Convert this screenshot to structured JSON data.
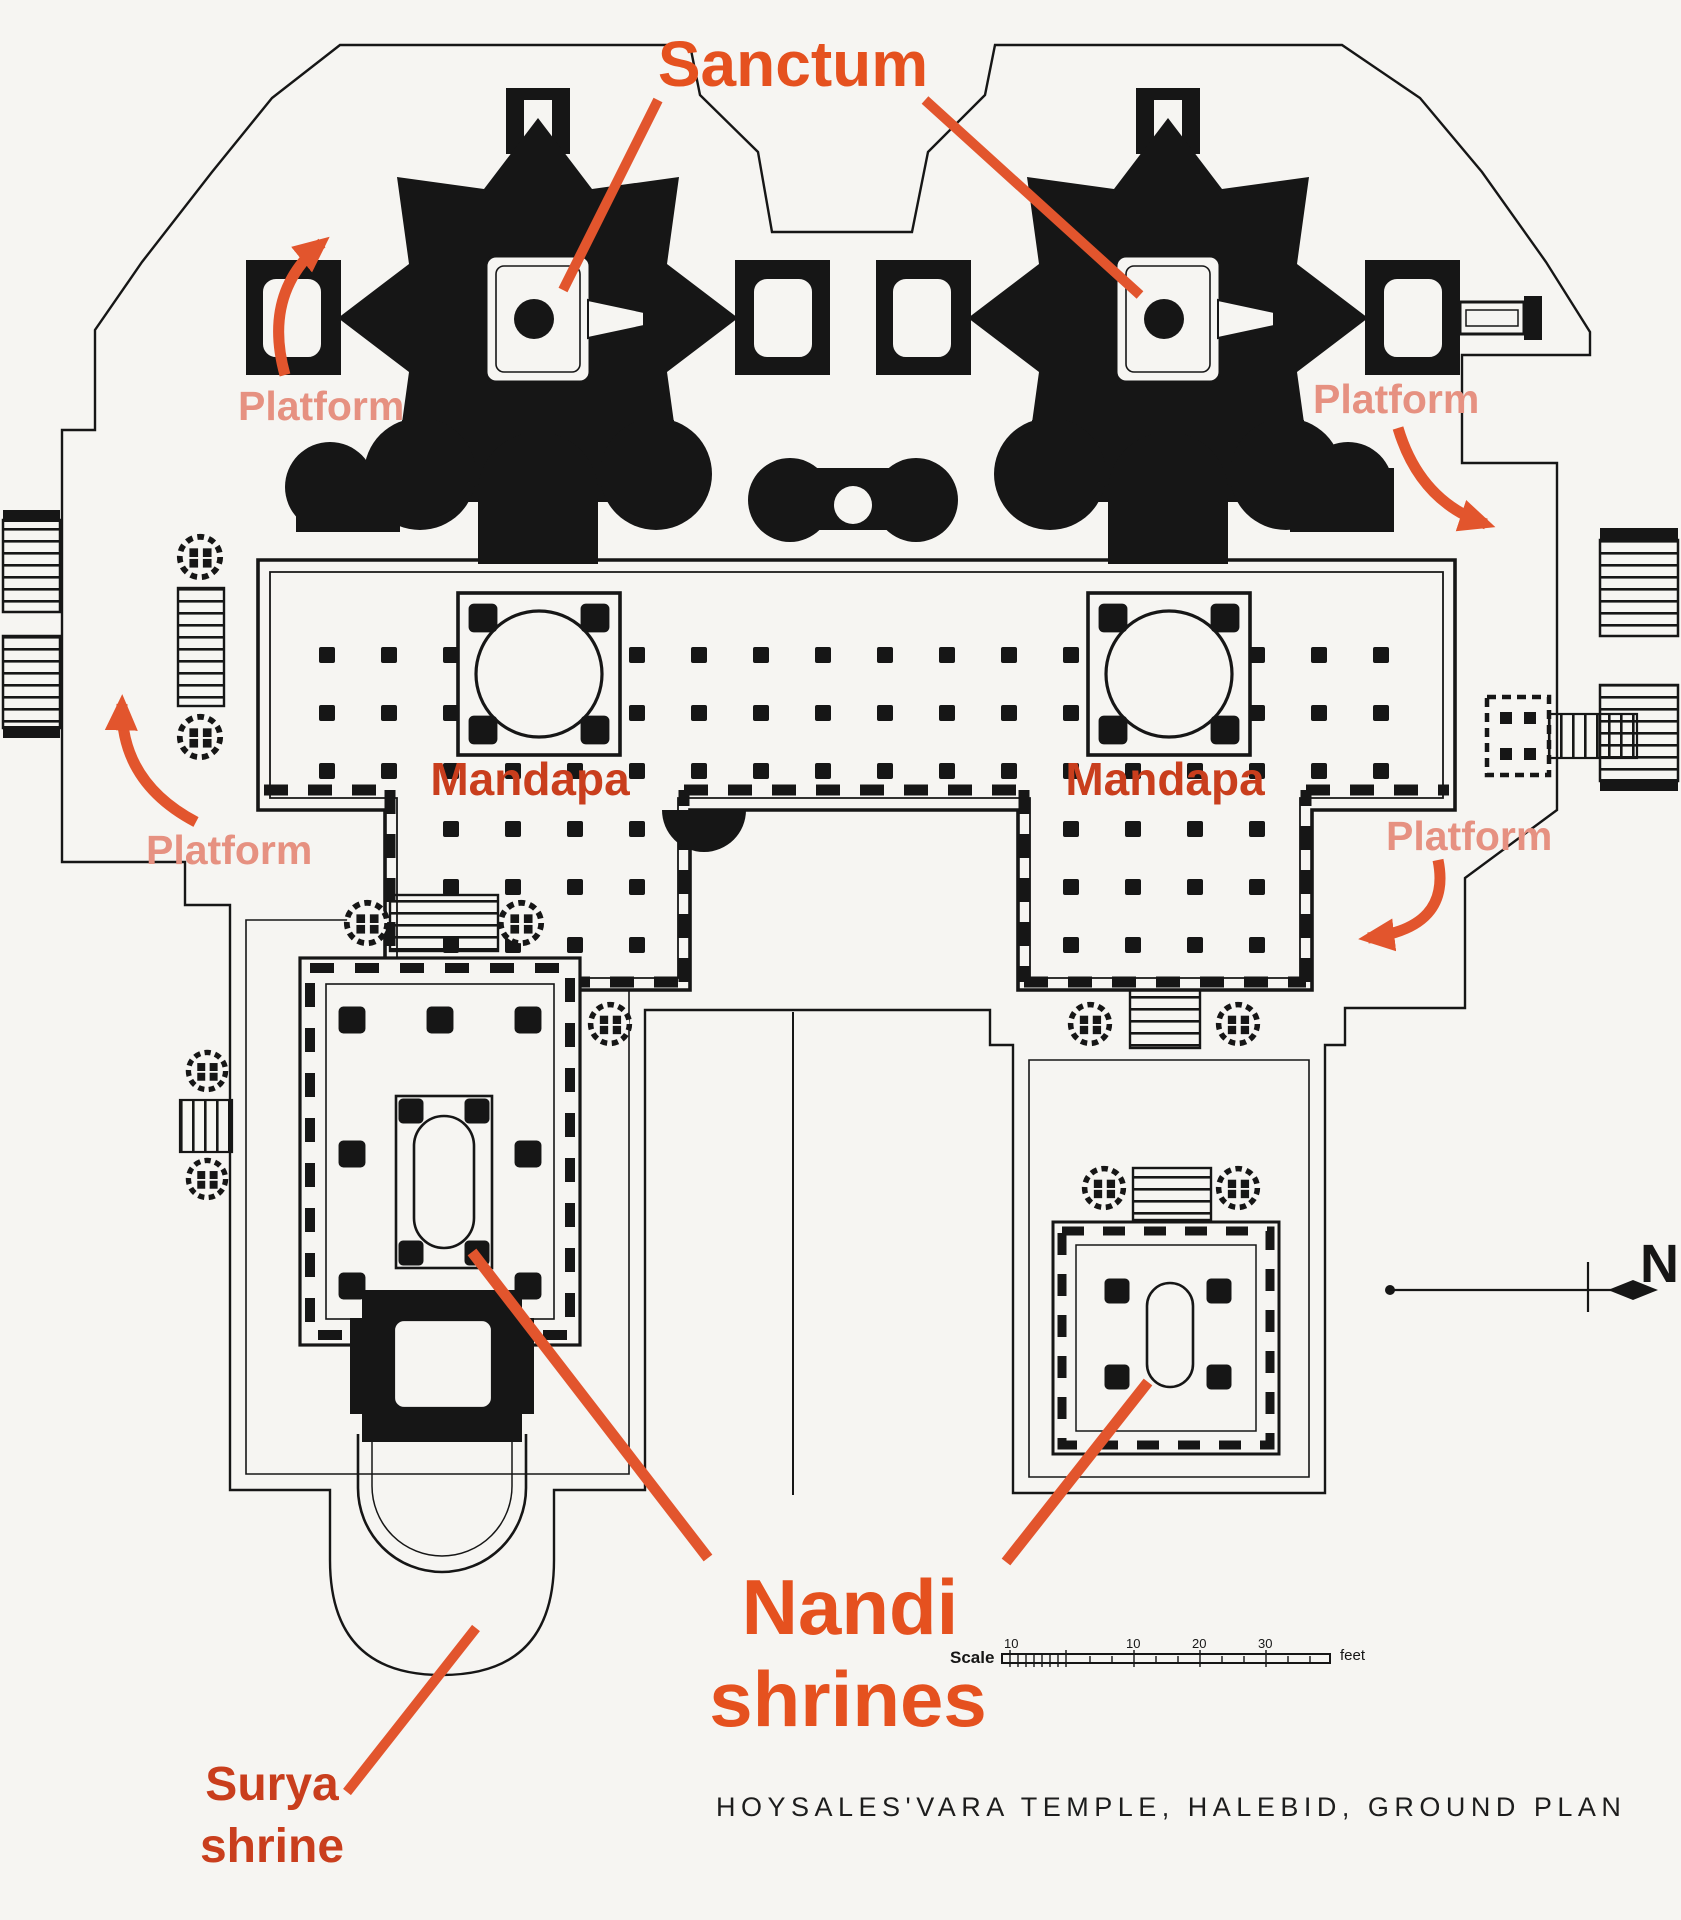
{
  "title": "Hoysaleswara Temple ground plan (annotated)",
  "colors": {
    "accent_orange": "#e5511f",
    "dark_red": "#c93e1d",
    "platform_salmon": "#e69181",
    "plan_ink": "#161616",
    "paper": "#f6f5f2"
  },
  "labels": {
    "sanctum": "Sanctum",
    "platform": [
      "Platform",
      "Platform",
      "Platform",
      "Platform"
    ],
    "mandapa": [
      "Mandapa",
      "Mandapa"
    ],
    "nandi": {
      "line1": "Nandi",
      "line2": "shrines"
    },
    "surya": {
      "line1": "Surya",
      "line2": "shrine"
    }
  },
  "compass": {
    "north": "N"
  },
  "scale_bar": {
    "label": "Scale",
    "ticks": [
      "10",
      "10",
      "20",
      "30"
    ],
    "unit": "feet"
  },
  "caption": "HOYSALES'VARA TEMPLE,  HALEBID, GROUND PLAN"
}
